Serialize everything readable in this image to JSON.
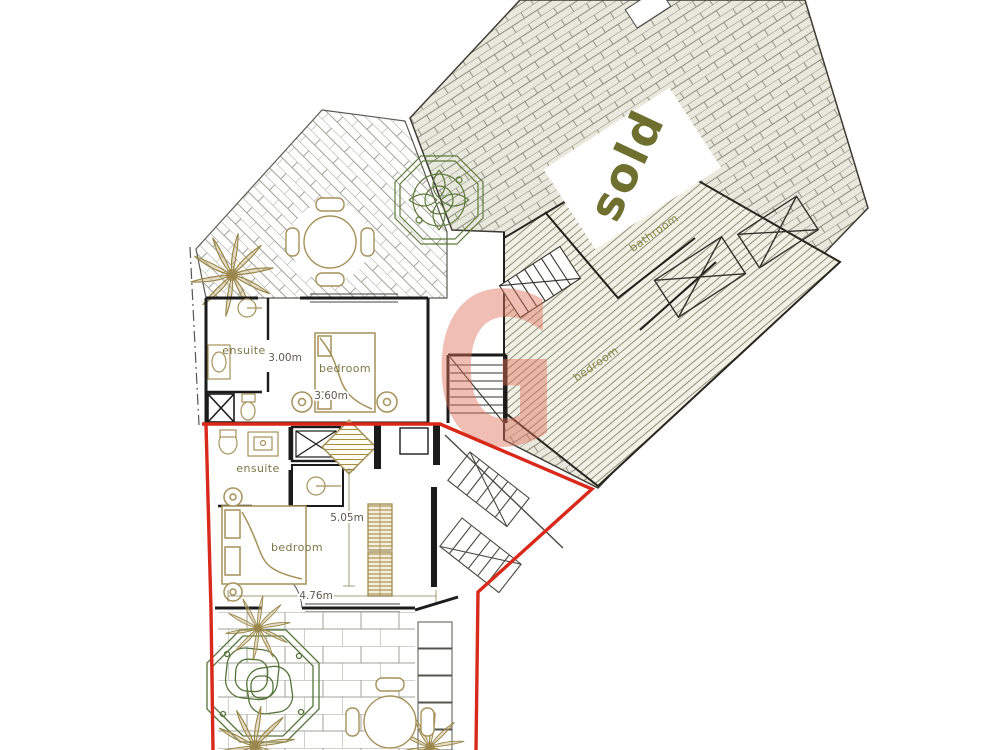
{
  "watermark": {
    "letter": "G",
    "color": "#e2705a"
  },
  "sold_unit": {
    "status": "sold",
    "bathroom_label": "bathroom",
    "bedroom_label": "bedroom"
  },
  "upper_apartment": {
    "ensuite_label": "ensuite",
    "bedroom_label": "bedroom",
    "room_width": "3.00m",
    "bed_width": "3.60m"
  },
  "lower_apartment": {
    "ensuite_label": "ensuite",
    "bedroom_label": "bedroom",
    "room_depth": "5.05m",
    "room_width": "4.76m"
  },
  "colors": {
    "boundary_red": "#d8291a",
    "furniture_khaki": "#a6915a",
    "landscaping_green": "#5d7a3b",
    "label_olive": "#6f7030",
    "walls_black": "#1b1b1b",
    "hatch_gray": "#8c8c7e"
  }
}
